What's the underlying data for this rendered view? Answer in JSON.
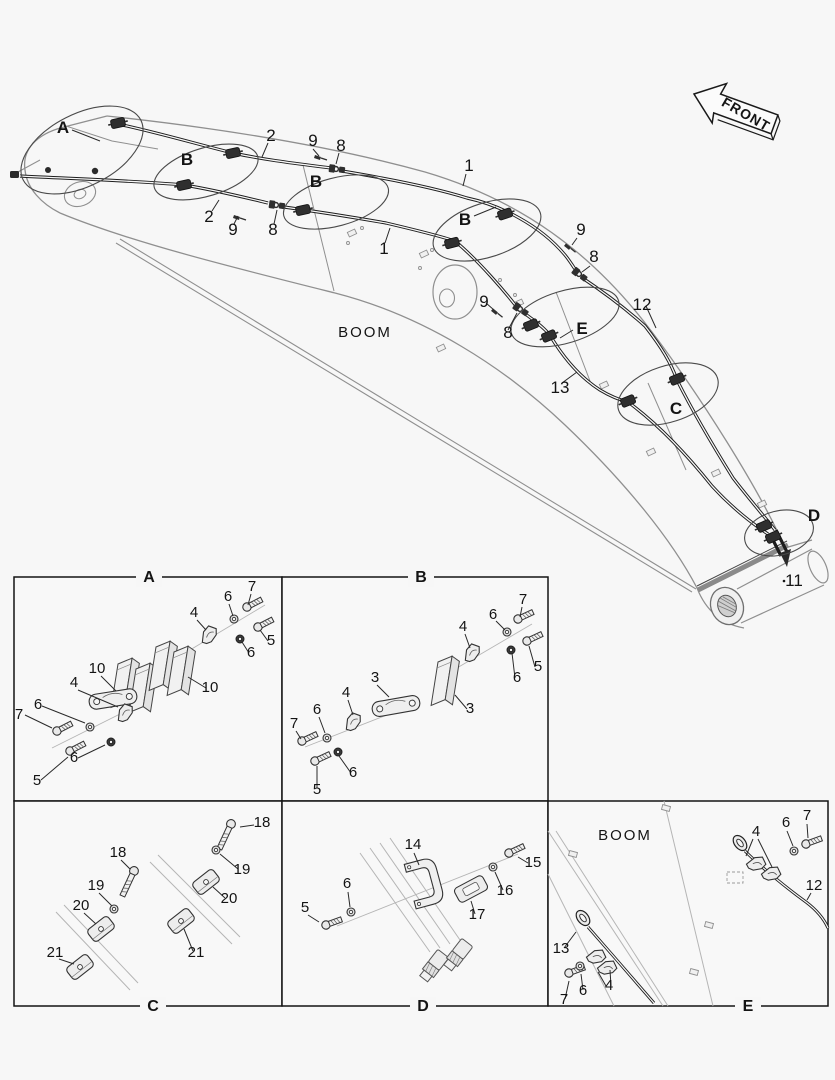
{
  "page": {
    "bg": "#f7f7f7",
    "ink": "#1d1d1d",
    "light_line": "#8f8f8f"
  },
  "front_arrow": {
    "label": "FRONT"
  },
  "boom_labels": {
    "main": "BOOM",
    "panel_e": "BOOM"
  },
  "diagram_labels": [
    {
      "t": "A",
      "x": 63,
      "y": 133,
      "k": "letter"
    },
    {
      "t": "B",
      "x": 187,
      "y": 165,
      "k": "letter"
    },
    {
      "t": "B",
      "x": 316,
      "y": 187,
      "k": "letter"
    },
    {
      "t": "B",
      "x": 465,
      "y": 225,
      "k": "letter"
    },
    {
      "t": "C",
      "x": 676,
      "y": 414,
      "k": "letter"
    },
    {
      "t": "D",
      "x": 814,
      "y": 521,
      "k": "letter"
    },
    {
      "t": "E",
      "x": 582,
      "y": 334,
      "k": "letter"
    },
    {
      "t": "2",
      "x": 271,
      "y": 141
    },
    {
      "t": "9",
      "x": 313,
      "y": 146
    },
    {
      "t": "8",
      "x": 341,
      "y": 151
    },
    {
      "t": "2",
      "x": 209,
      "y": 222
    },
    {
      "t": "9",
      "x": 233,
      "y": 235
    },
    {
      "t": "8",
      "x": 273,
      "y": 235
    },
    {
      "t": "1",
      "x": 384,
      "y": 254
    },
    {
      "t": "1",
      "x": 469,
      "y": 171
    },
    {
      "t": "9",
      "x": 581,
      "y": 235
    },
    {
      "t": "8",
      "x": 594,
      "y": 262
    },
    {
      "t": "9",
      "x": 484,
      "y": 307
    },
    {
      "t": "8",
      "x": 508,
      "y": 338
    },
    {
      "t": "12",
      "x": 642,
      "y": 310
    },
    {
      "t": "13",
      "x": 560,
      "y": 393
    },
    {
      "t": "11",
      "x": 794,
      "y": 586
    }
  ],
  "panel_tabs": [
    {
      "id": "A",
      "x": 149,
      "y": 582
    },
    {
      "id": "B",
      "x": 421,
      "y": 582
    },
    {
      "id": "C",
      "x": 153,
      "y": 1011
    },
    {
      "id": "D",
      "x": 423,
      "y": 1011
    },
    {
      "id": "E",
      "x": 748,
      "y": 1011
    }
  ],
  "panel_labels": {
    "A": [
      {
        "t": "7",
        "x": 19,
        "y": 719
      },
      {
        "t": "6",
        "x": 38,
        "y": 709
      },
      {
        "t": "4",
        "x": 74,
        "y": 687
      },
      {
        "t": "10",
        "x": 97,
        "y": 673
      },
      {
        "t": "5",
        "x": 37,
        "y": 785
      },
      {
        "t": "6",
        "x": 74,
        "y": 762
      },
      {
        "t": "6",
        "x": 228,
        "y": 601
      },
      {
        "t": "7",
        "x": 252,
        "y": 591
      },
      {
        "t": "4",
        "x": 194,
        "y": 617
      },
      {
        "t": "5",
        "x": 271,
        "y": 645
      },
      {
        "t": "6",
        "x": 251,
        "y": 657
      },
      {
        "t": "10",
        "x": 210,
        "y": 692
      }
    ],
    "B": [
      {
        "t": "3",
        "x": 375,
        "y": 682
      },
      {
        "t": "4",
        "x": 346,
        "y": 697
      },
      {
        "t": "6",
        "x": 317,
        "y": 714
      },
      {
        "t": "7",
        "x": 294,
        "y": 728
      },
      {
        "t": "6",
        "x": 353,
        "y": 777
      },
      {
        "t": "5",
        "x": 317,
        "y": 794
      },
      {
        "t": "7",
        "x": 523,
        "y": 604
      },
      {
        "t": "6",
        "x": 493,
        "y": 619
      },
      {
        "t": "4",
        "x": 463,
        "y": 631
      },
      {
        "t": "5",
        "x": 538,
        "y": 671
      },
      {
        "t": "6",
        "x": 517,
        "y": 682
      },
      {
        "t": "3",
        "x": 470,
        "y": 713
      }
    ],
    "C": [
      {
        "t": "18",
        "x": 118,
        "y": 857
      },
      {
        "t": "19",
        "x": 96,
        "y": 890
      },
      {
        "t": "20",
        "x": 81,
        "y": 910
      },
      {
        "t": "21",
        "x": 55,
        "y": 957
      },
      {
        "t": "18",
        "x": 262,
        "y": 827
      },
      {
        "t": "19",
        "x": 242,
        "y": 874
      },
      {
        "t": "20",
        "x": 229,
        "y": 903
      },
      {
        "t": "21",
        "x": 196,
        "y": 957
      }
    ],
    "D": [
      {
        "t": "5",
        "x": 305,
        "y": 912
      },
      {
        "t": "6",
        "x": 347,
        "y": 888
      },
      {
        "t": "14",
        "x": 413,
        "y": 849
      },
      {
        "t": "15",
        "x": 533,
        "y": 867
      },
      {
        "t": "16",
        "x": 505,
        "y": 895
      },
      {
        "t": "17",
        "x": 477,
        "y": 919
      }
    ],
    "E": [
      {
        "t": "4",
        "x": 756,
        "y": 836
      },
      {
        "t": "6",
        "x": 786,
        "y": 827
      },
      {
        "t": "7",
        "x": 807,
        "y": 820
      },
      {
        "t": "12",
        "x": 814,
        "y": 890
      },
      {
        "t": "13",
        "x": 561,
        "y": 953
      },
      {
        "t": "7",
        "x": 564,
        "y": 1004
      },
      {
        "t": "6",
        "x": 583,
        "y": 995
      },
      {
        "t": "4",
        "x": 609,
        "y": 990
      }
    ]
  }
}
